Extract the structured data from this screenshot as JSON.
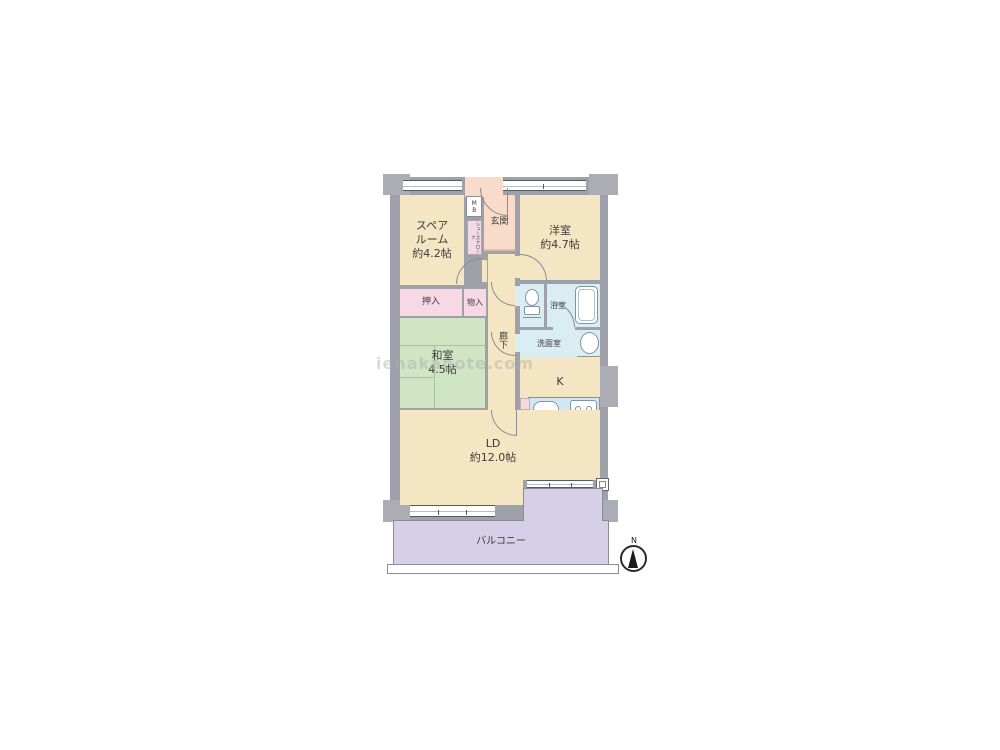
{
  "watermark": "ienakanote.com",
  "compass": {
    "north_label": "N"
  },
  "rooms": {
    "spare_room": {
      "label": "スペア\nルーム\n約4.2帖"
    },
    "western_room": {
      "label": "洋室\n約4.7帖"
    },
    "entrance": {
      "label": "玄関"
    },
    "meter_box": {
      "label": "MB"
    },
    "shoe_closet": {
      "label": "シューズクローク"
    },
    "closet_oshiire": {
      "label": "押入"
    },
    "closet_monoire": {
      "label": "物入"
    },
    "japanese_room": {
      "label": "和室\n4.5帖"
    },
    "corridor": {
      "label": "廊下"
    },
    "bathroom": {
      "label": "浴室"
    },
    "washroom": {
      "label": "洗面室"
    },
    "kitchen": {
      "label": "K"
    },
    "living_dining": {
      "label": "LD\n約12.0帖"
    },
    "balcony": {
      "label": "バルコニー"
    }
  },
  "colors": {
    "wall": "#9fa1aa",
    "pillar": "#abacb4",
    "room_cream": "#f4e6c3",
    "entrance_salmon": "#f8dbc9",
    "closet_pink": "#f8d8e2",
    "tatami_green": "#cfe5c4",
    "wet_blue": "#d9edf3",
    "balcony_purple": "#d6cfe7",
    "washer_tan": "#e9d5a5"
  }
}
